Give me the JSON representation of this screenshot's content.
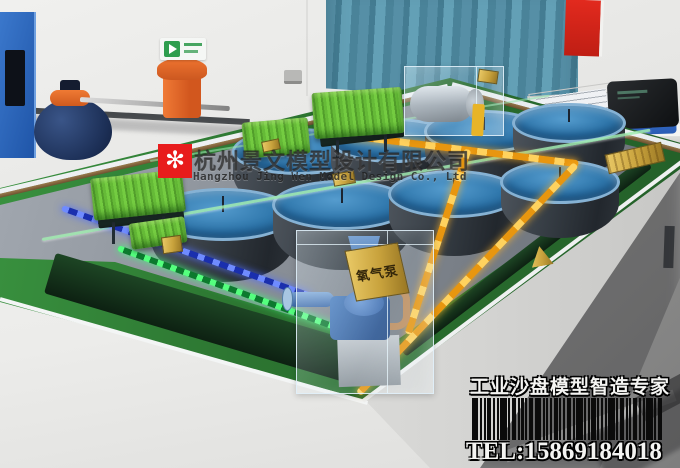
{
  "watermark": {
    "logo_glyph": "✻",
    "company_cn": "杭州景文模型设计有限公司",
    "company_en": "Hangzhou Jing Wen Model Design Co., Ltd"
  },
  "footer": {
    "slogan": "工业沙盘模型智造专家",
    "phone": "TEL:15869184018",
    "barcode_pattern": [
      3,
      1,
      1,
      2,
      1,
      1,
      3,
      1,
      2,
      1,
      1,
      1,
      2,
      3,
      1,
      1,
      1,
      2,
      1,
      1,
      2,
      1,
      3,
      1,
      1,
      2,
      1,
      1,
      1,
      3,
      1,
      2,
      1,
      1,
      2,
      1,
      1,
      3,
      1,
      2
    ]
  },
  "model": {
    "oxygen_pump_sign": "氧气泵",
    "tanks_back_row": 4,
    "tanks_front_row": 4
  },
  "palette": {
    "felt_green": "#2e7d32",
    "tank_water_blue": "#2f7fb5",
    "pipe_amber": "#efa51e",
    "led_green": "#3ae664",
    "led_blue": "#4f6dff",
    "brand_red": "#e81c1c",
    "gold": "#c9a94e",
    "curtain_teal": "#4f8ba1"
  }
}
